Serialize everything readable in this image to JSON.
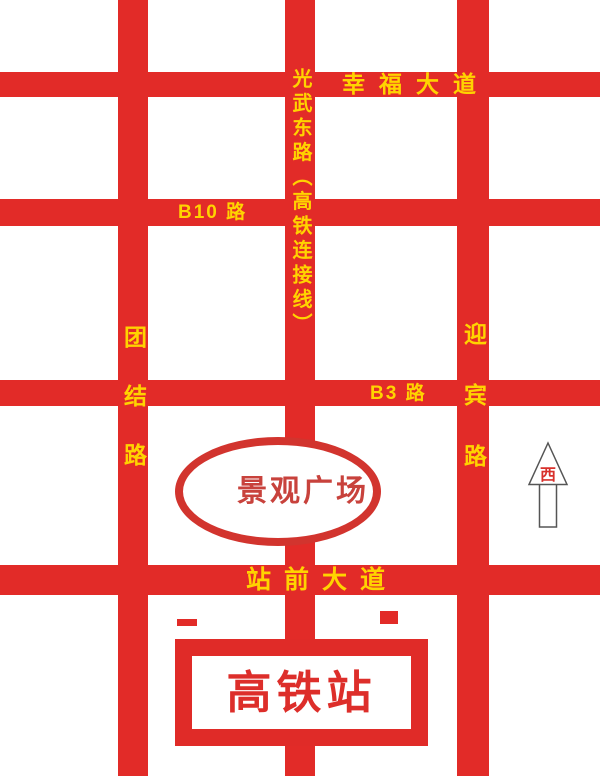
{
  "colors": {
    "road_red": "#E22B28",
    "label_yellow": "#FFD300",
    "plaza_stroke_red": "#D2342E",
    "plaza_text_red": "#C8423C",
    "station_box_red": "#E02B28",
    "station_text_red": "#DD2E2A",
    "arrow_outline_gray": "#555555",
    "background": "#FFFFFF"
  },
  "roads": {
    "horizontal": [
      {
        "name": "幸福大道"
      },
      {
        "name": "B10 路"
      },
      {
        "name": "B3 路"
      },
      {
        "name": "站前大道"
      }
    ],
    "vertical": [
      {
        "name": "团结路"
      },
      {
        "name": "光武东路（高铁连接线）"
      },
      {
        "name": "迎宾路"
      }
    ]
  },
  "landmarks": {
    "plaza": {
      "label": "景观广场",
      "shape": "ellipse"
    },
    "station": {
      "label": "高铁站",
      "shape": "rectangle"
    }
  },
  "compass": {
    "label": "西",
    "direction": "up"
  }
}
